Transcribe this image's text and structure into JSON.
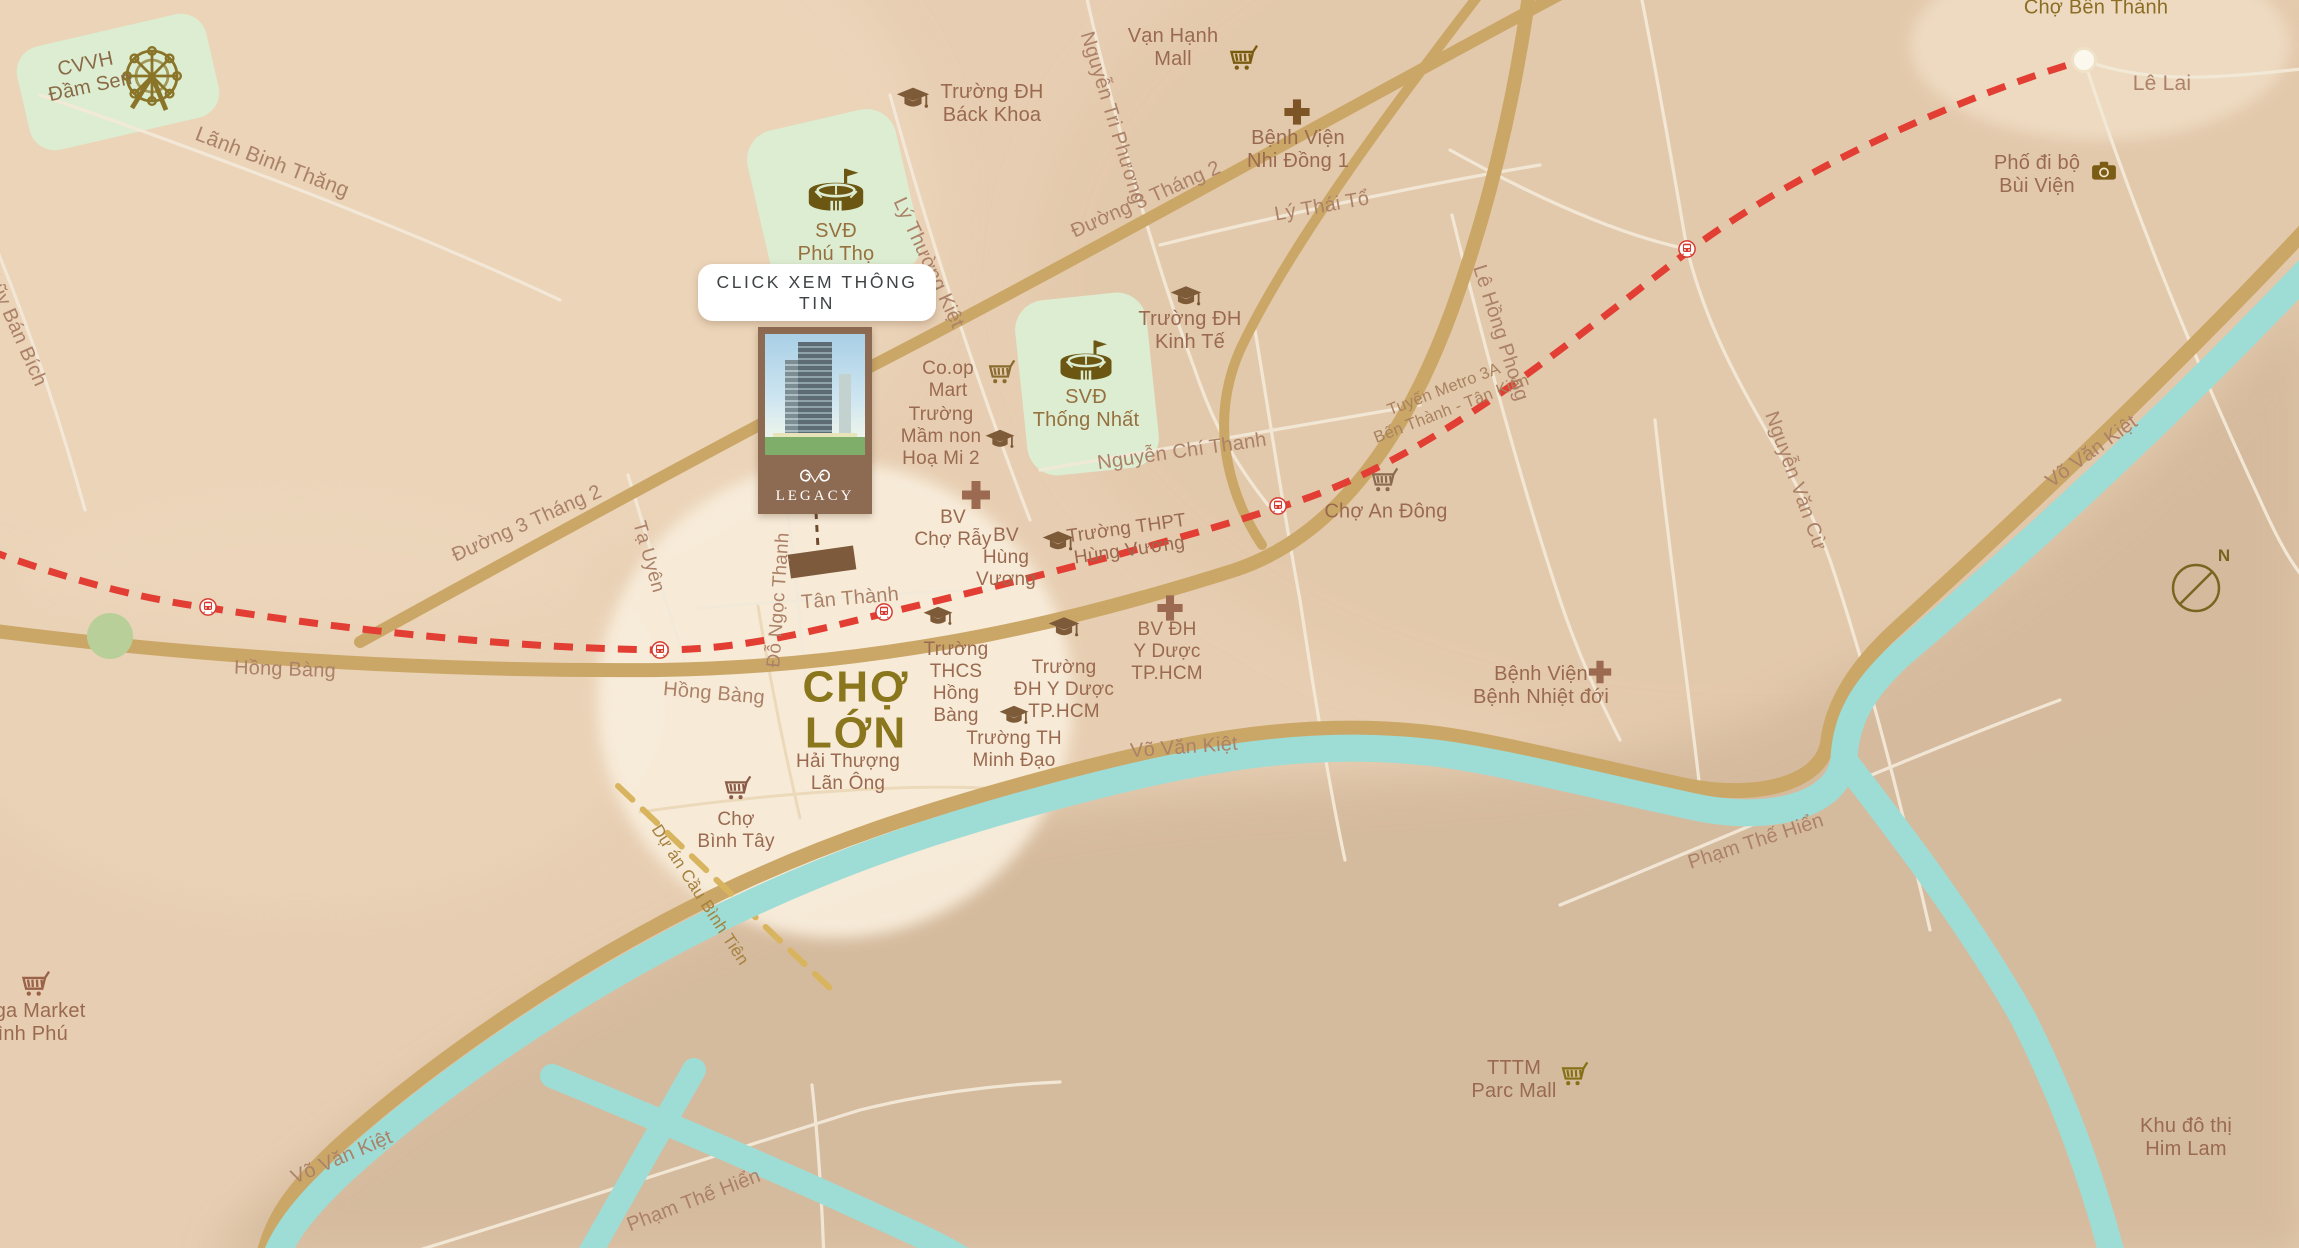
{
  "map": {
    "button_label": "CLICK XEM THÔNG TIN",
    "project": {
      "name": "LEGACY"
    },
    "compass": "N",
    "colors": {
      "land": "#e7ceb2",
      "land_light": "#eed8bd",
      "land_ne": "#e2c6a9",
      "land_dark": "#d4b99c",
      "circle": "#f8eddb",
      "green_patch": "#dcedd2",
      "green_dot": "#b9cf9a",
      "road_gold": "#cba767",
      "road_white": "#f3e9d8",
      "water": "#9edcd6",
      "metro_red": "#e23e33",
      "proj_road": "#d9b45e",
      "road_label": "#ab8168",
      "poi_label": "#9a6a50",
      "big_label": "#8a761c",
      "icon_brown": "#7d5a38",
      "stadium_gold": "#6b5612",
      "button_text": "#3f4345",
      "card_brown": "#8d6a52",
      "marker": "#7d5a3c",
      "compass": "#7a6420"
    },
    "labels": [
      {
        "n": "label-cvvh-dam-sen",
        "t": "CVVH\nĐầm Sen",
        "x": 88,
        "y": 76,
        "r": -12,
        "cls": "poi",
        "fs": 20,
        "c": "#8a6a45"
      },
      {
        "n": "label-lanh-binh-thang",
        "t": "Lãnh Binh Thăng",
        "x": 272,
        "y": 163,
        "r": 21,
        "cls": "road",
        "fs": 21
      },
      {
        "n": "label-luy-ban-bich",
        "t": "Lũy Bán Bích",
        "x": 16,
        "y": 330,
        "r": 66,
        "cls": "road",
        "fs": 20
      },
      {
        "n": "label-duong-3-thang-2-west",
        "t": "Đường 3 Tháng 2",
        "x": 527,
        "y": 524,
        "r": -24,
        "cls": "road",
        "fs": 20
      },
      {
        "n": "label-duong-3-thang-2-north",
        "t": "Đường 3 Tháng 2",
        "x": 1146,
        "y": 200,
        "r": -24,
        "cls": "road",
        "fs": 20
      },
      {
        "n": "label-ta-uyen",
        "t": "Tạ Uyên",
        "x": 648,
        "y": 557,
        "r": 74,
        "cls": "road",
        "fs": 19
      },
      {
        "n": "label-do-ngoc-thanh",
        "t": "Đỗ Ngọc Thạnh",
        "x": 779,
        "y": 600,
        "r": -86,
        "cls": "road",
        "fs": 19
      },
      {
        "n": "label-ly-thuong-kiet",
        "t": "Lý Thường Kiệt",
        "x": 928,
        "y": 263,
        "r": 65,
        "cls": "road",
        "fs": 20
      },
      {
        "n": "label-nguyen-tri-phuong",
        "t": "Nguyễn Tri Phương",
        "x": 1112,
        "y": 118,
        "r": 73,
        "cls": "road",
        "fs": 20
      },
      {
        "n": "label-ly-thai-to",
        "t": "Lý Thái Tổ",
        "x": 1322,
        "y": 207,
        "r": -10,
        "cls": "road",
        "fs": 20
      },
      {
        "n": "label-nguyen-chi-thanh",
        "t": "Nguyễn Chí Thanh",
        "x": 1182,
        "y": 452,
        "r": -8,
        "cls": "road",
        "fs": 20
      },
      {
        "n": "label-le-hong-phong",
        "t": "Lê Hồng Phong",
        "x": 1500,
        "y": 333,
        "r": 72,
        "cls": "road",
        "fs": 20
      },
      {
        "n": "label-nguyen-van-cu",
        "t": "Nguyễn Văn Cừ",
        "x": 1795,
        "y": 481,
        "r": 70,
        "cls": "road",
        "fs": 20
      },
      {
        "n": "label-vo-van-kiet-east",
        "t": "Võ Văn Kiệt",
        "x": 2092,
        "y": 452,
        "r": -36,
        "cls": "road",
        "fs": 20
      },
      {
        "n": "label-vo-van-kiet-center",
        "t": "Võ Văn Kiệt",
        "x": 1184,
        "y": 748,
        "r": -4,
        "cls": "road",
        "fs": 20
      },
      {
        "n": "label-vo-van-kiet-west",
        "t": "Võ Văn Kiệt",
        "x": 342,
        "y": 1158,
        "r": -23,
        "cls": "road",
        "fs": 20
      },
      {
        "n": "label-hong-bang-west",
        "t": "Hồng Bàng",
        "x": 285,
        "y": 670,
        "r": 2,
        "cls": "road",
        "fs": 20
      },
      {
        "n": "label-hong-bang-circle",
        "t": "Hồng Bàng",
        "x": 714,
        "y": 694,
        "r": 5,
        "cls": "road",
        "fs": 20
      },
      {
        "n": "label-tan-thanh",
        "t": "Tân Thành",
        "x": 850,
        "y": 599,
        "r": -5,
        "cls": "road",
        "fs": 20
      },
      {
        "n": "label-pham-the-hien-east",
        "t": "Phạm Thế Hiển",
        "x": 1756,
        "y": 842,
        "r": -18,
        "cls": "road",
        "fs": 20
      },
      {
        "n": "label-pham-the-hien-south",
        "t": "Phạm Thế Hiển",
        "x": 694,
        "y": 1201,
        "r": -21,
        "cls": "road",
        "fs": 20
      },
      {
        "n": "label-le-lai",
        "t": "Lê Lai",
        "x": 2162,
        "y": 84,
        "r": 0,
        "cls": "road",
        "fs": 21
      },
      {
        "n": "label-du-an-cau-binh-tien",
        "t": "Dự án Cầu Bình Tiên",
        "x": 700,
        "y": 895,
        "r": 57,
        "cls": "proj",
        "fs": 17
      },
      {
        "n": "label-metro-line",
        "t": "Tuyến Metro 3A\nBến Thành - Tân Kiên",
        "x": 1448,
        "y": 400,
        "r": -21,
        "cls": "metro",
        "fs": 16.5
      },
      {
        "n": "label-cho-ben-thanh",
        "t": "Chợ Bến Thành",
        "x": 2096,
        "y": 8,
        "r": 0,
        "cls": "gold",
        "fs": 20
      },
      {
        "n": "label-cho-lon",
        "t": "CHỢ\nLỚN",
        "x": 856,
        "y": 710,
        "r": 0,
        "cls": "big",
        "fs": 44
      },
      {
        "n": "label-truong-dh-bach-khoa",
        "t": "Trường ĐH\nBáck Khoa",
        "x": 992,
        "y": 104,
        "r": 0,
        "cls": "poi",
        "fs": 20
      },
      {
        "n": "label-van-hanh-mall",
        "t": "Vạn Hạnh\nMall",
        "x": 1173,
        "y": 48,
        "r": 0,
        "cls": "poi",
        "fs": 20
      },
      {
        "n": "label-benh-vien-nhi-dong-1",
        "t": "Bệnh Viện\nNhi Đồng 1",
        "x": 1298,
        "y": 150,
        "r": 0,
        "cls": "poi",
        "fs": 20
      },
      {
        "n": "label-pho-di-bo-bui-vien",
        "t": "Phố đi bộ\nBùi Viện",
        "x": 2037,
        "y": 175,
        "r": 0,
        "cls": "poi",
        "fs": 20
      },
      {
        "n": "label-svd-phu-tho",
        "t": "SVĐ\nPhú Thọ",
        "x": 836,
        "y": 243,
        "r": 0,
        "cls": "poi",
        "fs": 20,
        "c": "#97703f"
      },
      {
        "n": "label-svd-thong-nhat",
        "t": "SVĐ\nThống Nhất",
        "x": 1086,
        "y": 409,
        "r": 0,
        "cls": "poi",
        "fs": 20,
        "c": "#97703f"
      },
      {
        "n": "label-truong-dh-kinh-te",
        "t": "Trường ĐH\nKinh Tế",
        "x": 1190,
        "y": 331,
        "r": 0,
        "cls": "poi",
        "fs": 20
      },
      {
        "n": "label-co-op-mart",
        "t": "Co.op\nMart",
        "x": 948,
        "y": 380,
        "r": 0,
        "cls": "poi",
        "fs": 19
      },
      {
        "n": "label-truong-mam-non-hoa-mi-2",
        "t": "Trường\nMầm non\nHoạ Mi 2",
        "x": 941,
        "y": 437,
        "r": 0,
        "cls": "poi",
        "fs": 19
      },
      {
        "n": "label-bv-cho-ray",
        "t": "BV\nChợ Rẫy",
        "x": 953,
        "y": 529,
        "r": 0,
        "cls": "poi",
        "fs": 19
      },
      {
        "n": "label-bv-hung-vuong",
        "t": "BV\nHùng\nVương",
        "x": 1006,
        "y": 558,
        "r": 0,
        "cls": "poi",
        "fs": 19
      },
      {
        "n": "label-truong-thpt-hung-vuong",
        "t": "Trường THPT\nHùng Vương",
        "x": 1128,
        "y": 540,
        "r": -8,
        "cls": "poi",
        "fs": 19
      },
      {
        "n": "label-truong-thcs-hong-bang",
        "t": "Trường\nTHCS\nHồng\nBàng",
        "x": 956,
        "y": 683,
        "r": 0,
        "cls": "poi",
        "fs": 19
      },
      {
        "n": "label-truong-dh-y-duoc",
        "t": "Trường\nĐH Y Dược\nTP.HCM",
        "x": 1064,
        "y": 690,
        "r": 0,
        "cls": "poi",
        "fs": 19
      },
      {
        "n": "label-bv-dh-y-duoc",
        "t": "BV ĐH\nY Dược\nTP.HCM",
        "x": 1167,
        "y": 652,
        "r": 0,
        "cls": "poi",
        "fs": 19
      },
      {
        "n": "label-truong-th-minh-dao",
        "t": "Trường TH\nMinh Đạo",
        "x": 1014,
        "y": 750,
        "r": 0,
        "cls": "poi",
        "fs": 19
      },
      {
        "n": "label-hai-thuong-lan-ong",
        "t": "Hải Thượng\nLãn Ông",
        "x": 848,
        "y": 773,
        "r": 0,
        "cls": "poi",
        "fs": 19
      },
      {
        "n": "label-cho-binh-tay",
        "t": "Chợ\nBình Tây",
        "x": 736,
        "y": 831,
        "r": 0,
        "cls": "poi",
        "fs": 19
      },
      {
        "n": "label-cho-an-dong",
        "t": "Chợ An Đông",
        "x": 1386,
        "y": 512,
        "r": 0,
        "cls": "poi",
        "fs": 20
      },
      {
        "n": "label-benh-vien-nhiet-doi",
        "t": "Bệnh Viện\nBệnh Nhiệt đới",
        "x": 1541,
        "y": 686,
        "r": 0,
        "cls": "poi",
        "fs": 20
      },
      {
        "n": "label-mega-market-binh-phu",
        "t": "Mega Market\nBình Phú",
        "x": 26,
        "y": 1023,
        "r": 0,
        "cls": "poi",
        "fs": 20
      },
      {
        "n": "label-tttm-parc-mall",
        "t": "TTTM\nParc Mall",
        "x": 1514,
        "y": 1080,
        "r": 0,
        "cls": "poi",
        "fs": 20
      },
      {
        "n": "label-khu-do-thi-him-lam",
        "t": "Khu đô thị\nHim Lam",
        "x": 2186,
        "y": 1138,
        "r": 0,
        "cls": "poi",
        "fs": 20
      }
    ],
    "icons": [
      {
        "n": "ferris-wheel-icon",
        "k": "ferris",
        "x": 152,
        "y": 76,
        "s": 80,
        "c": "#8a7428"
      },
      {
        "n": "stadium-icon",
        "k": "stadium",
        "x": 836,
        "y": 196,
        "s": 64
      },
      {
        "n": "stadium-icon",
        "k": "stadium",
        "x": 1086,
        "y": 366,
        "s": 60
      },
      {
        "n": "graduation-cap-icon",
        "k": "cap",
        "x": 913,
        "y": 99,
        "s": 38
      },
      {
        "n": "shopping-cart-icon",
        "k": "cart",
        "x": 1244,
        "y": 60,
        "s": 36,
        "c": "#7a5c10"
      },
      {
        "n": "hospital-cross-icon",
        "k": "cross",
        "x": 1297,
        "y": 112,
        "s": 36,
        "c": "#7d5426"
      },
      {
        "n": "camera-icon",
        "k": "camera",
        "x": 2104,
        "y": 172,
        "s": 34,
        "c": "#7a5c14"
      },
      {
        "n": "shopping-cart-icon",
        "k": "cart",
        "x": 1002,
        "y": 374,
        "s": 34,
        "c": "#8a6c30"
      },
      {
        "n": "graduation-cap-icon",
        "k": "cap",
        "x": 1000,
        "y": 440,
        "s": 34
      },
      {
        "n": "graduation-cap-icon",
        "k": "cap",
        "x": 1186,
        "y": 297,
        "s": 36
      },
      {
        "n": "hospital-cross-icon",
        "k": "cross",
        "x": 976,
        "y": 495,
        "s": 40,
        "c": "#9c6a50"
      },
      {
        "n": "graduation-cap-icon",
        "k": "cap",
        "x": 1058,
        "y": 542,
        "s": 36
      },
      {
        "n": "graduation-cap-icon",
        "k": "cap",
        "x": 938,
        "y": 617,
        "s": 34
      },
      {
        "n": "graduation-cap-icon",
        "k": "cap",
        "x": 1064,
        "y": 628,
        "s": 36
      },
      {
        "n": "hospital-cross-icon",
        "k": "cross",
        "x": 1170,
        "y": 608,
        "s": 36,
        "c": "#9c6a50"
      },
      {
        "n": "graduation-cap-icon",
        "k": "cap",
        "x": 1014,
        "y": 716,
        "s": 34
      },
      {
        "n": "shopping-cart-icon",
        "k": "cart",
        "x": 738,
        "y": 790,
        "s": 34,
        "c": "#8a5c48"
      },
      {
        "n": "shopping-cart-icon",
        "k": "cart",
        "x": 1385,
        "y": 482,
        "s": 34,
        "c": "#8a6a50"
      },
      {
        "n": "hospital-cross-icon",
        "k": "cross",
        "x": 1600,
        "y": 672,
        "s": 32,
        "c": "#9c6a50"
      },
      {
        "n": "shopping-cart-icon",
        "k": "cart",
        "x": 36,
        "y": 986,
        "s": 36,
        "c": "#9a6248"
      },
      {
        "n": "shopping-cart-icon",
        "k": "cart",
        "x": 1575,
        "y": 1076,
        "s": 34,
        "c": "#857015"
      },
      {
        "n": "metro-station-icon",
        "k": "train",
        "x": 208,
        "y": 607,
        "s": 27
      },
      {
        "n": "metro-station-icon",
        "k": "train",
        "x": 660,
        "y": 650,
        "s": 27
      },
      {
        "n": "metro-station-icon",
        "k": "train",
        "x": 884,
        "y": 612,
        "s": 27
      },
      {
        "n": "metro-station-icon",
        "k": "train",
        "x": 1278,
        "y": 506,
        "s": 27
      },
      {
        "n": "metro-station-icon",
        "k": "train",
        "x": 1687,
        "y": 249,
        "s": 27
      }
    ]
  }
}
